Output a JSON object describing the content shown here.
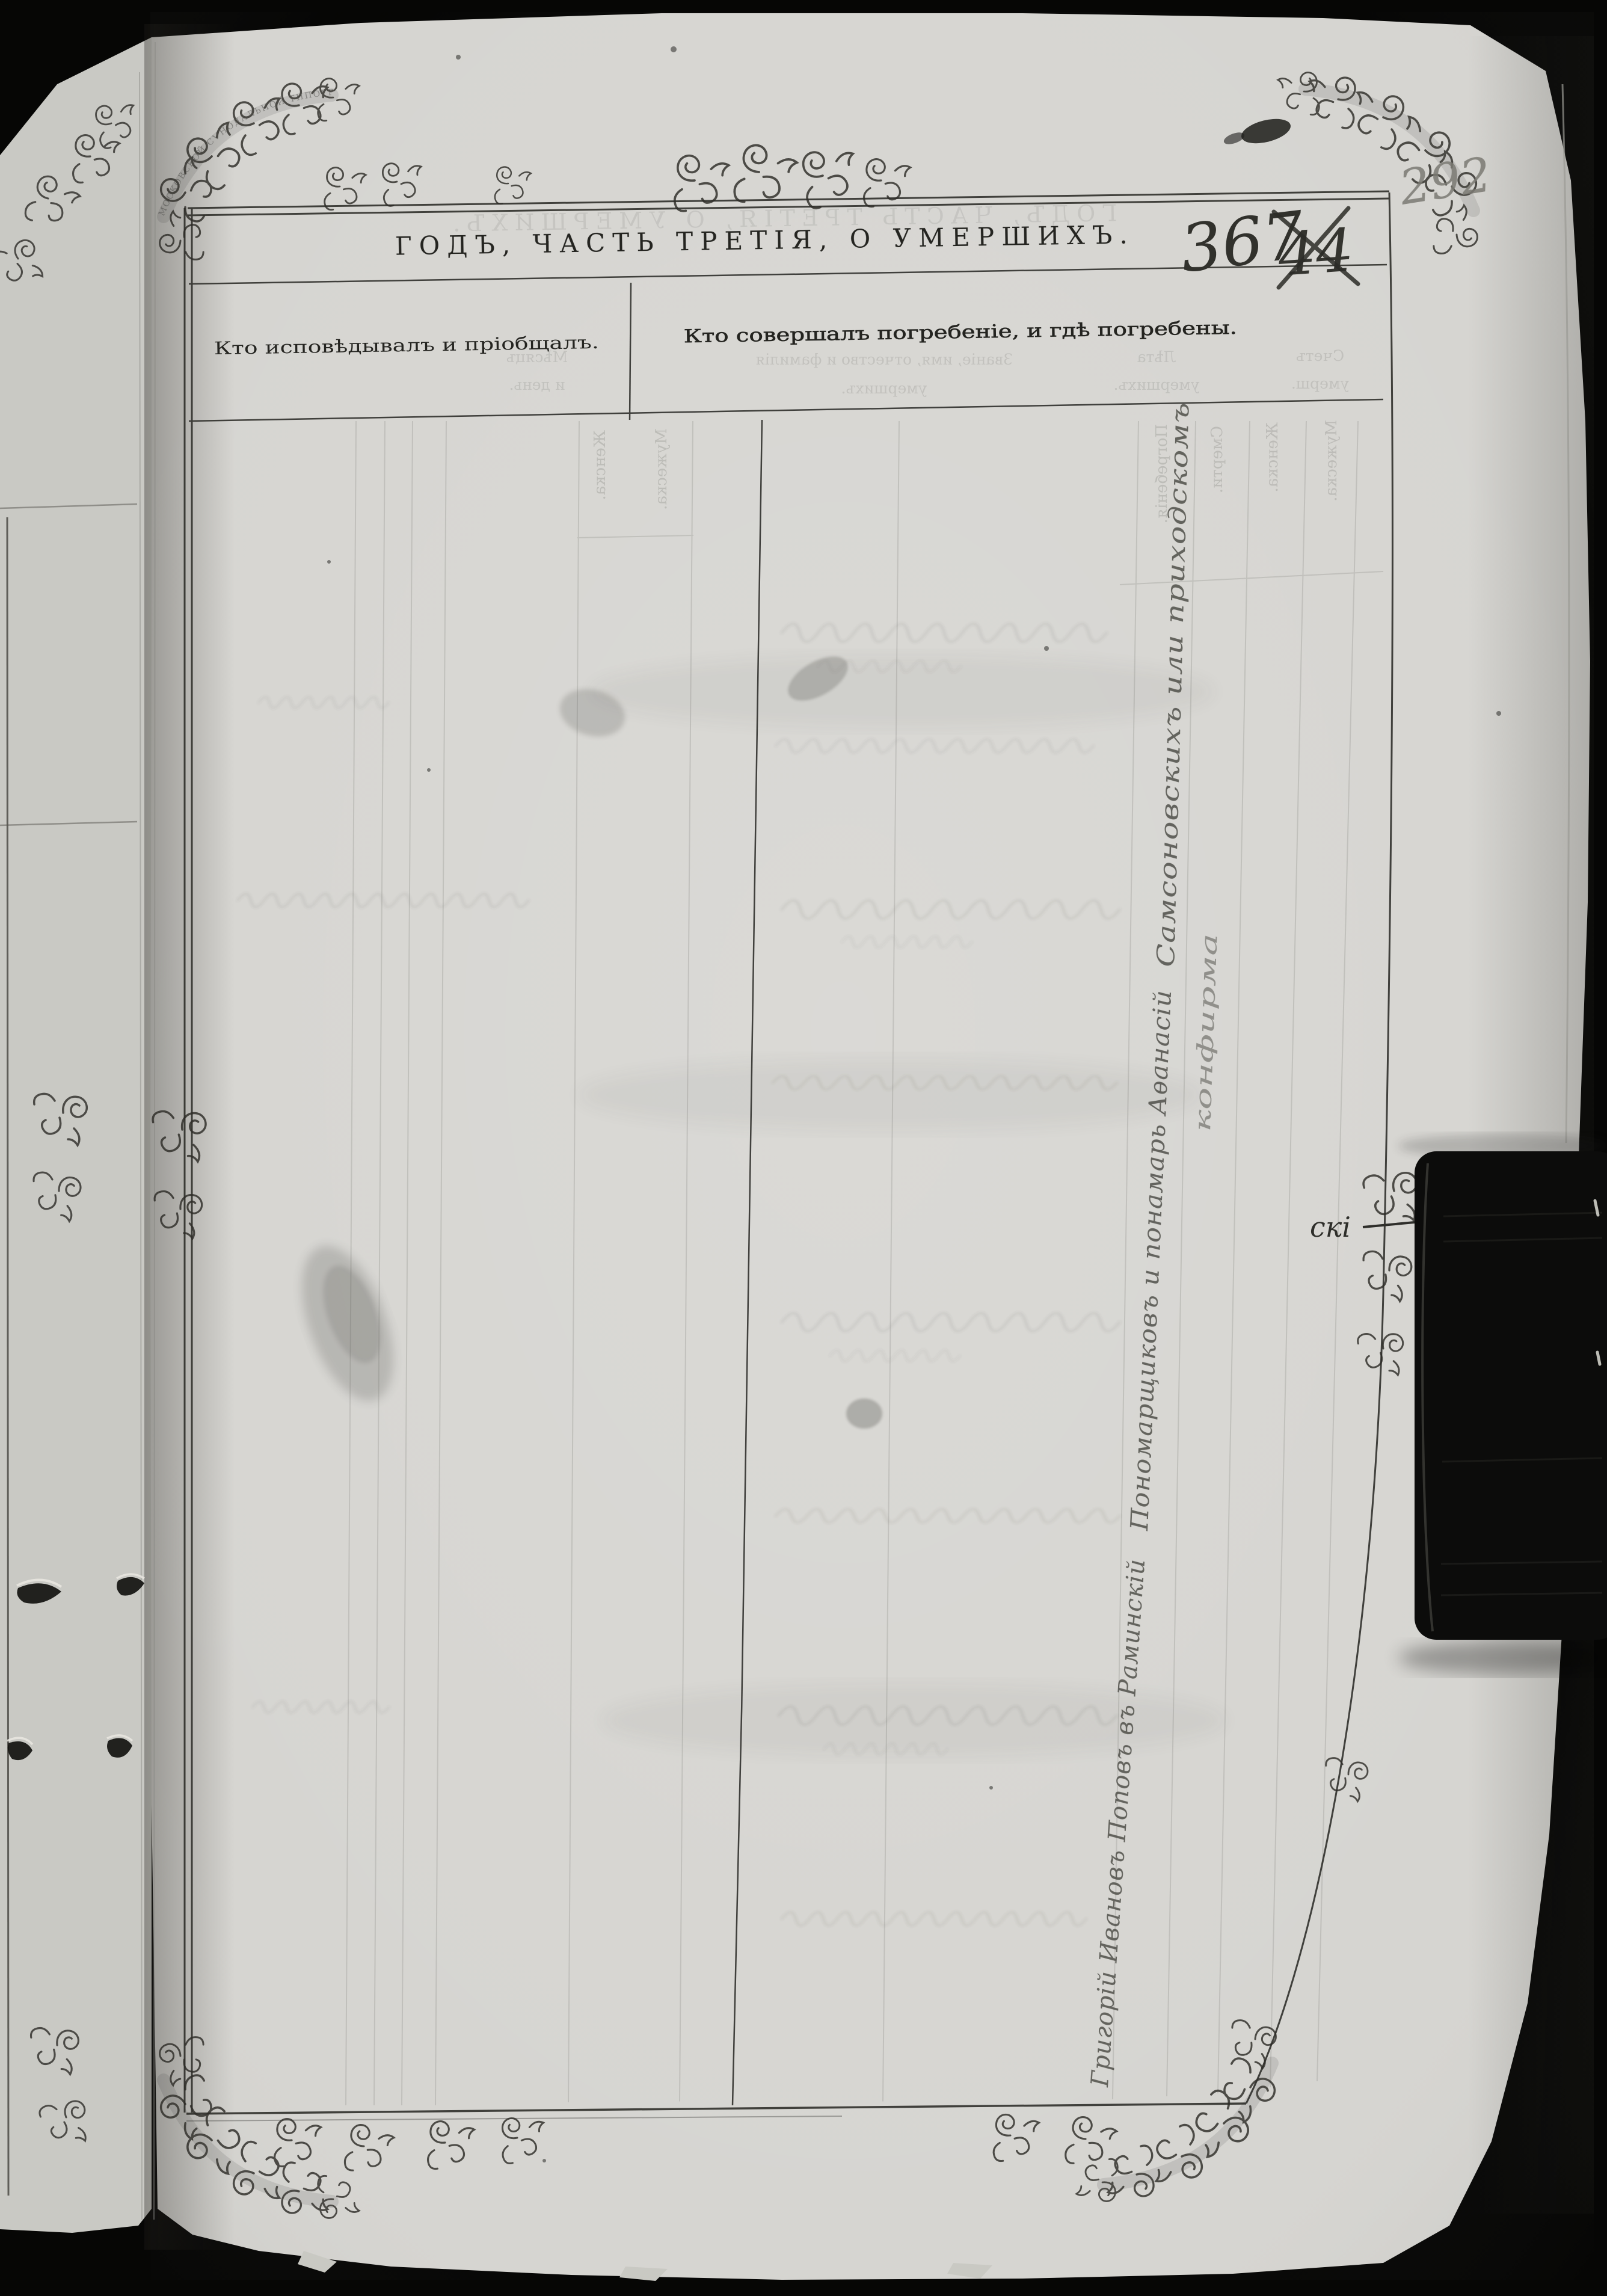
{
  "scan": {
    "kind": "archival scan of a metrical book page (deaths section)",
    "page_number_pencil": "292",
    "folio_number_ink": "367",
    "folio_number_crossed_out": "44"
  },
  "printed": {
    "title": "ГОДЪ, ЧАСТЬ ТРЕТІЯ, О УМЕРШИХЪ.",
    "column_headers": {
      "left": "Кто исповѣдывалъ и пріобщалъ.",
      "right": "Кто совершалъ погребеніе, и гдѣ погребены."
    },
    "border_banner_text": "МОСКОВСКОЙ СѴНОДАЛЬНОЙ ТИПОГРАФІИ"
  },
  "handwriting": {
    "vertical_note_segments": [
      "Григорій Ивановъ Поповъ въ Раминскій",
      "Пономарщиковъ и понамарь Аѳанасій",
      "Самсоновскихъ или приходскомъ"
    ],
    "vertical_note_secondary": "конфирма",
    "margin_continuation": "скі"
  },
  "bleedthrough": {
    "title_mirrored": "ГОДЪ, ЧАСТЬ ТРЕТІЯ, О УМЕРШИХЪ.",
    "header_cells": [
      {
        "line1": "Мѣсяцъ",
        "line2": "и день."
      },
      {
        "line1": "Званіе, имя, отчество и фамилія",
        "line2": "умершихъ."
      },
      {
        "line1": "Лѣта",
        "line2": "умершихъ."
      },
      {
        "line1": "Счетъ",
        "line2": "умерш."
      }
    ],
    "age_subcolumns": [
      "Женска.",
      "Мужеска."
    ],
    "count_subcolumns": [
      "Погребенія.",
      "Смерти.",
      "Женска.",
      "Мужеска."
    ]
  }
}
